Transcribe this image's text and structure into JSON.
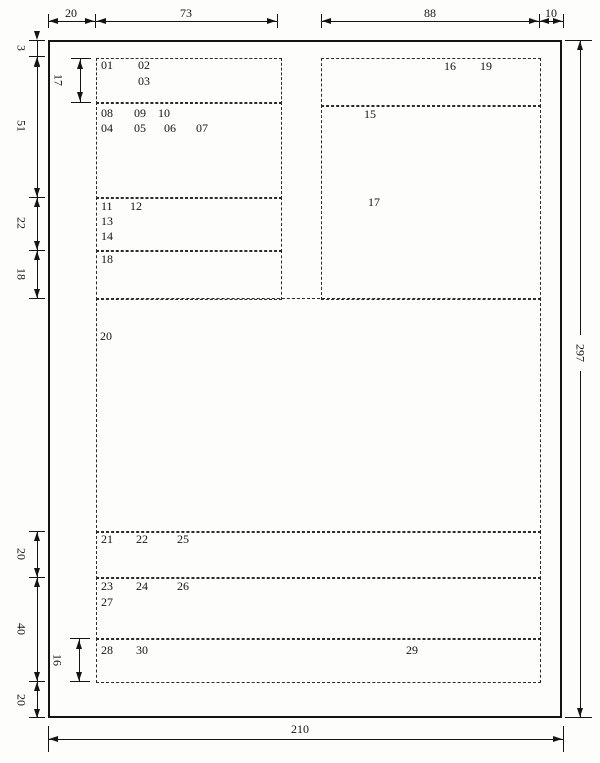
{
  "dim_top": [
    "20",
    "73",
    "88",
    "10"
  ],
  "dim_left": [
    "3",
    "51",
    "22",
    "18",
    "20",
    "40",
    "20"
  ],
  "dim_inner": [
    "17",
    "16"
  ],
  "dim_right": "297",
  "dim_bottom": "210",
  "fields": {
    "f01": "01",
    "f02": "02",
    "f03": "03",
    "f04": "04",
    "f05": "05",
    "f06": "06",
    "f07": "07",
    "f08": "08",
    "f09": "09",
    "f10": "10",
    "f11": "11",
    "f12": "12",
    "f13": "13",
    "f14": "14",
    "f15": "15",
    "f16": "16",
    "f17": "17",
    "f18": "18",
    "f19": "19",
    "f20": "20",
    "f21": "21",
    "f22": "22",
    "f23": "23",
    "f24": "24",
    "f25": "25",
    "f26": "26",
    "f27": "27",
    "f28": "28",
    "f29": "29",
    "f30": "30"
  }
}
